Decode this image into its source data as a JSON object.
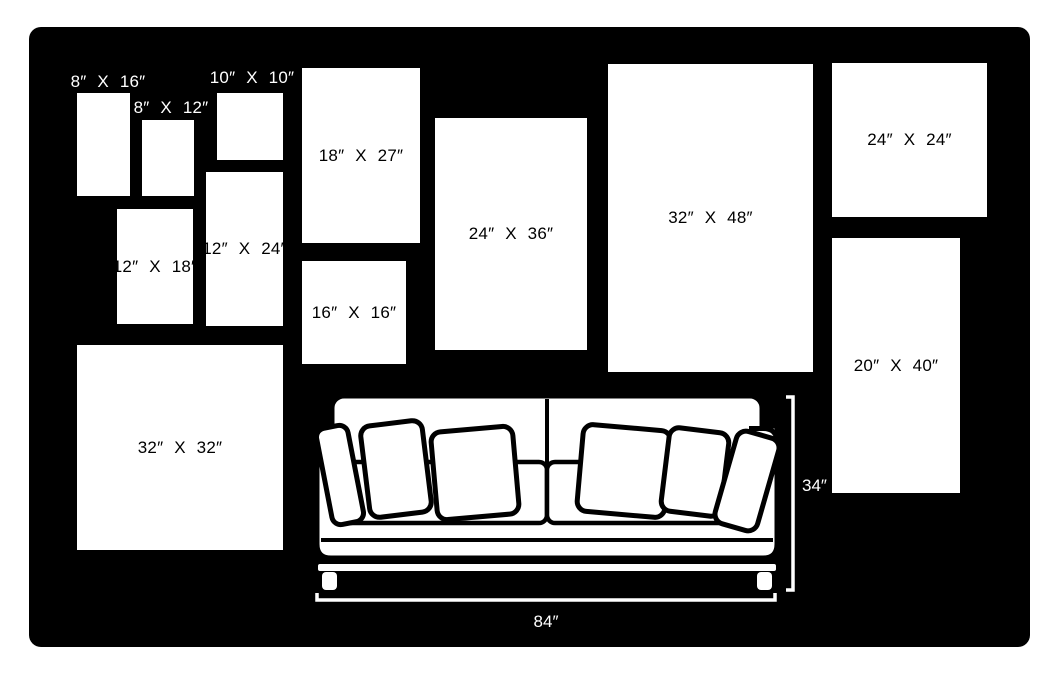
{
  "palette": {
    "page_background": "#ffffff",
    "board_background": "#000000",
    "frame_fill": "#ffffff",
    "frame_text": "#000000",
    "board_text": "#ffffff",
    "outline_color": "#000000"
  },
  "frames": [
    {
      "id": "8x16",
      "label": "8″ X 16″",
      "width_in": 8,
      "height_in": 16,
      "label_placement": "above"
    },
    {
      "id": "8x12",
      "label": "8″ X 12″",
      "width_in": 8,
      "height_in": 12,
      "label_placement": "above"
    },
    {
      "id": "10x10",
      "label": "10″ X 10″",
      "width_in": 10,
      "height_in": 10,
      "label_placement": "above"
    },
    {
      "id": "12x18",
      "label": "12″ X 18″",
      "width_in": 12,
      "height_in": 18,
      "label_placement": "inside"
    },
    {
      "id": "12x24",
      "label": "12″ X 24″",
      "width_in": 12,
      "height_in": 24,
      "label_placement": "inside"
    },
    {
      "id": "18x27",
      "label": "18″ X 27″",
      "width_in": 18,
      "height_in": 27,
      "label_placement": "inside"
    },
    {
      "id": "16x16",
      "label": "16″ X 16″",
      "width_in": 16,
      "height_in": 16,
      "label_placement": "inside"
    },
    {
      "id": "24x36",
      "label": "24″ X 36″",
      "width_in": 24,
      "height_in": 36,
      "label_placement": "inside"
    },
    {
      "id": "32x48",
      "label": "32″ X 48″",
      "width_in": 32,
      "height_in": 48,
      "label_placement": "inside"
    },
    {
      "id": "24x24",
      "label": "24″ X 24″",
      "width_in": 24,
      "height_in": 24,
      "label_placement": "inside"
    },
    {
      "id": "20x40",
      "label": "20″ X 40″",
      "width_in": 20,
      "height_in": 40,
      "label_placement": "inside"
    },
    {
      "id": "32x32",
      "label": "32″ X 32″",
      "width_in": 32,
      "height_in": 32,
      "label_placement": "inside"
    }
  ],
  "sofa": {
    "width_label": "84″",
    "height_label": "34″",
    "width_in": 84,
    "height_in": 34,
    "pillow_count": 6,
    "seat_cushion_count": 2
  }
}
